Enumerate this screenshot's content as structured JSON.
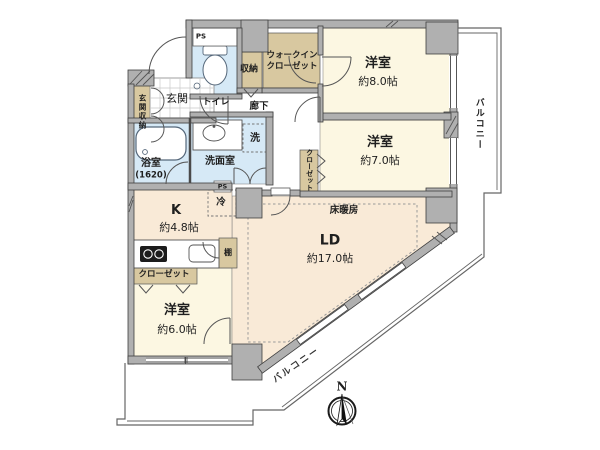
{
  "labels": {
    "entrance": "玄関",
    "entrance_storage": "玄関収納",
    "toilet": "トイレ",
    "ps_top": "PS",
    "ps_mid": "PS",
    "storage": "収納",
    "wic_line1": "ウォークイン",
    "wic_line2": "クローゼット",
    "hallway": "廊下",
    "bedroom8_name": "洋室",
    "bedroom8_size": "約8.0帖",
    "bedroom7_name": "洋室",
    "bedroom7_size": "約7.0帖",
    "bedroom6_name": "洋室",
    "bedroom6_size": "約6.0帖",
    "closet7": "クローゼット",
    "closet6": "クローゼット",
    "bath_name": "浴室",
    "bath_size": "(1620)",
    "washroom": "洗面室",
    "laundry": "洗",
    "living_name": "LD",
    "living_size": "約17.0帖",
    "floor_heating": "床暖房",
    "kitchen_name": "K",
    "kitchen_size": "約4.8帖",
    "fridge": "冷",
    "shelf": "棚",
    "balcony_right": "バルコニー",
    "balcony_bottom": "バルコニー",
    "compass_north": "N"
  },
  "colors": {
    "room_cream": "#FCF7E2",
    "room_peach": "#F9EAD7",
    "room_blue": "#D6E9F6",
    "closet_tan": "#D8C8A0",
    "wall_grey": "#B0B0B0",
    "line_dark": "#3F3F3F"
  }
}
